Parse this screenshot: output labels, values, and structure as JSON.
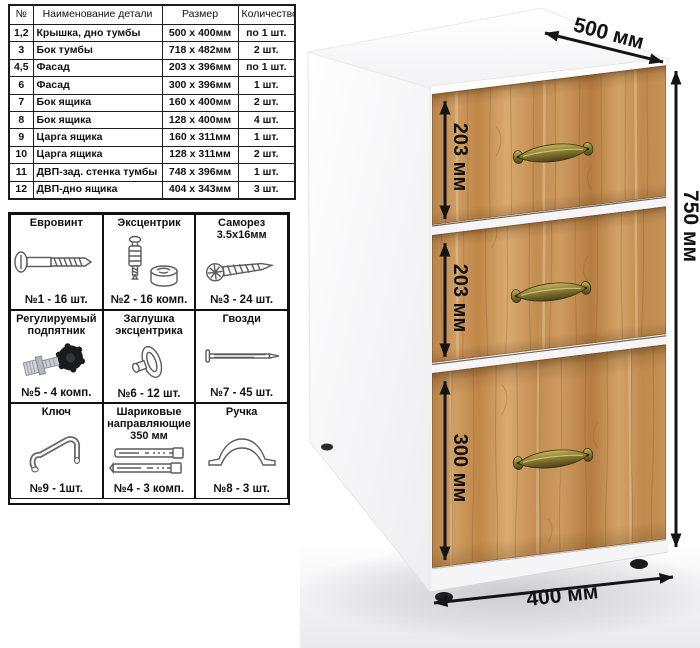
{
  "parts_table": {
    "headers": [
      "№",
      "Наименование детали",
      "Размер",
      "Количество"
    ],
    "rows": [
      {
        "num": "1,2",
        "name": "Крышка, дно тумбы",
        "size": "500 x 400мм",
        "qty": "по 1 шт."
      },
      {
        "num": "3",
        "name": "Бок тумбы",
        "size": "718 x 482мм",
        "qty": "2 шт."
      },
      {
        "num": "4,5",
        "name": "Фасад",
        "size": "203 x 396мм",
        "qty": "по 1 шт."
      },
      {
        "num": "6",
        "name": "Фасад",
        "size": "300 x 396мм",
        "qty": "1 шт."
      },
      {
        "num": "7",
        "name": "Бок ящика",
        "size": "160 x 400мм",
        "qty": "2 шт."
      },
      {
        "num": "8",
        "name": "Бок ящика",
        "size": "128 x 400мм",
        "qty": "4 шт."
      },
      {
        "num": "9",
        "name": "Царга ящика",
        "size": "160 x 311мм",
        "qty": "1 шт."
      },
      {
        "num": "10",
        "name": "Царга ящика",
        "size": "128 x 311мм",
        "qty": "2 шт."
      },
      {
        "num": "11",
        "name": "ДВП-зад. стенка тумбы",
        "size": "748 x 396мм",
        "qty": "1 шт."
      },
      {
        "num": "12",
        "name": "ДВП-дно ящика",
        "size": "404 x 343мм",
        "qty": "3 шт."
      }
    ]
  },
  "hardware": {
    "items": [
      {
        "title": "Евровинт",
        "count": "№1 - 16 шт."
      },
      {
        "title": "Эксцентрик",
        "count": "№2 - 16 комп."
      },
      {
        "title": "Саморез\n3.5х16мм",
        "count": "№3 - 24 шт."
      },
      {
        "title": "Регулируемый\nподпятник",
        "count": "№5 - 4 комп."
      },
      {
        "title": "Заглушка\nэксцентрика",
        "count": "№6 - 12 шт."
      },
      {
        "title": "Гвозди",
        "count": "№7 - 45 шт."
      },
      {
        "title": "Ключ",
        "count": "№9 - 1шт."
      },
      {
        "title": "Шариковые\nнаправляющие\n350 мм",
        "count": "№4 - 3 комп."
      },
      {
        "title": "Ручка",
        "count": "№8 - 3 шт."
      }
    ]
  },
  "dimensions": {
    "depth": "500 мм",
    "height": "750 мм",
    "width": "400 мм",
    "drawer1": "203 мм",
    "drawer2": "203 мм",
    "drawer3": "300 мм"
  },
  "colors": {
    "wood_base": "#c68f55",
    "arrow": "#141414",
    "handle_brass": "#8a7c33"
  }
}
